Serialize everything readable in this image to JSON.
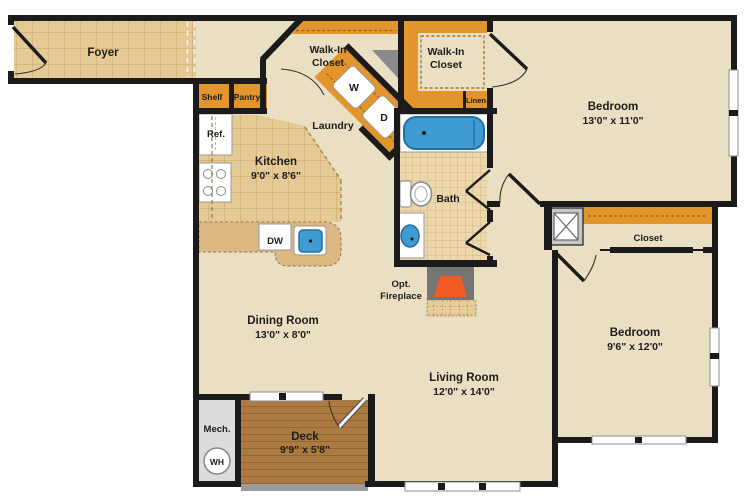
{
  "rooms": {
    "foyer": {
      "name": "Foyer"
    },
    "walk_in_closet_1": {
      "name_line1": "Walk-In",
      "name_line2": "Closet"
    },
    "walk_in_closet_2": {
      "name_line1": "Walk-In",
      "name_line2": "Closet"
    },
    "kitchen": {
      "name": "Kitchen",
      "dims": "9'0\" x 8'6\""
    },
    "laundry": {
      "name": "Laundry"
    },
    "bath": {
      "name": "Bath"
    },
    "bedroom_top": {
      "name": "Bedroom",
      "dims": "13'0\" x 11'0\""
    },
    "bedroom_right": {
      "name": "Bedroom",
      "dims": "9'6\" x 12'0\""
    },
    "closet": {
      "name": "Closet"
    },
    "dining_room": {
      "name": "Dining Room",
      "dims": "13'0\" x 8'0\""
    },
    "living_room": {
      "name": "Living Room",
      "dims": "12'0\" x 14'0\""
    },
    "deck": {
      "name": "Deck",
      "dims": "9'9\" x 5'8\""
    },
    "mech": {
      "name": "Mech."
    }
  },
  "fixtures": {
    "shelf": "Shelf",
    "pantry": "Pantry",
    "refrigerator": "Ref.",
    "dishwasher": "DW",
    "washer": "W",
    "dryer": "D",
    "linen": "Linen",
    "water_heater": "WH",
    "fireplace_line1": "Opt.",
    "fireplace_line2": "Fireplace"
  },
  "colors": {
    "floor": "#EADFC2",
    "tile": "#E5CA96",
    "tile_line": "#C7A264",
    "bath_tile": "#ECD8AC",
    "counter": "#DCB983",
    "shelving_orange": "#E2952D",
    "deck_wood": "#AD7B41",
    "wall": "#1B1B1B",
    "fixture_blue": "#3E9CD3",
    "fireplace_gray": "#757575",
    "firebox_orange": "#F25B24",
    "mech_gray": "#DCDCDC"
  }
}
